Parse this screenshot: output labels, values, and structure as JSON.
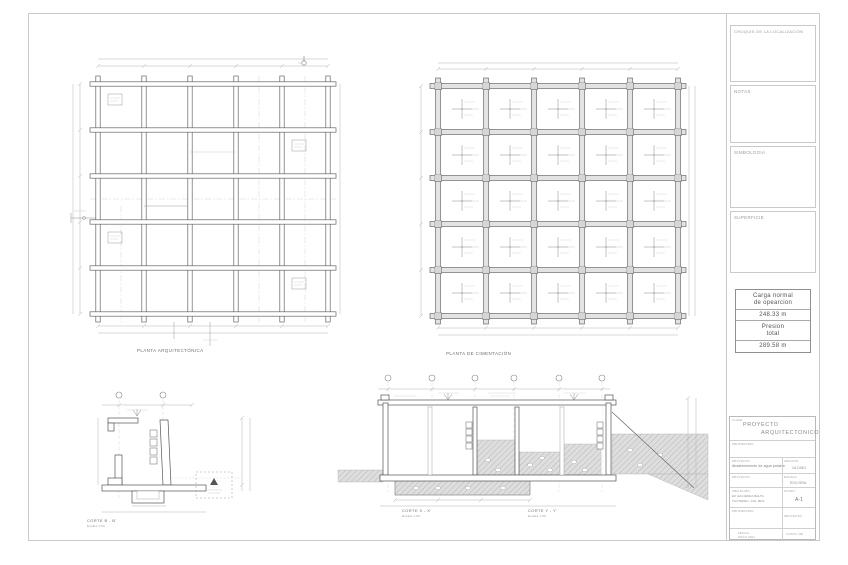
{
  "side_panel": {
    "croquis": "CROQUIS  DE  LA  LOCALIZACIÓN",
    "notas": "NOTAS",
    "simbologia": "SIMBOLOGIA",
    "superficie": "SUPERFICIE"
  },
  "load_table": {
    "row1_line1": "Carga  normal",
    "row1_line2": "de  opearcion",
    "row1_value": "248.33  m",
    "row2_line1": "Presion",
    "row2_line2": "total",
    "row2_value": "289.58  m"
  },
  "title_block": {
    "clave_label": "CLAVE:",
    "title_line1": "PROYECTO",
    "title_line2": "ARQUITECTONICO",
    "propietario_label": "PROPIETARIO:",
    "proyecto_label": "PROYECTO:",
    "proyecto_value": "Abastecimiento de agua potable",
    "archivo_label": "ARCHIVO:",
    "archivo_value": "1A  DWG",
    "contenido_label": "PROYECTO:",
    "escala_label": "ESCALA:",
    "escala_value": "ESC/GRA",
    "ubicacion_label": "UBICACIÓN:",
    "ubicacion_value1": "EX  HACIENDA  BALTA",
    "ubicacion_value2": "TUXTEPEC,  COL  BCS",
    "plano_label": "PLANO:",
    "plano_value": "A-1",
    "propietario2_label": "PROPIETARIO:",
    "proyecto2_label": "PROYECTÓ:",
    "fecha_label": "FECHA:",
    "fecha_value": "MAYO  2021",
    "cotas_label": "COTAS:  (M)"
  },
  "captions": {
    "plan_left": "PLANTA  ARQUITECTÓNICA",
    "plan_right": "PLANTA  DE  CIMENTACIÓN",
    "section_b": "CORTE  B - B'",
    "section_b_scale": "Escala  1:50",
    "section_x": "CORTE  X - X'",
    "section_x_scale": "Escala  1:50",
    "section_y": "CORTE  Y - Y'",
    "section_y_scale": "Escala  1:50"
  }
}
